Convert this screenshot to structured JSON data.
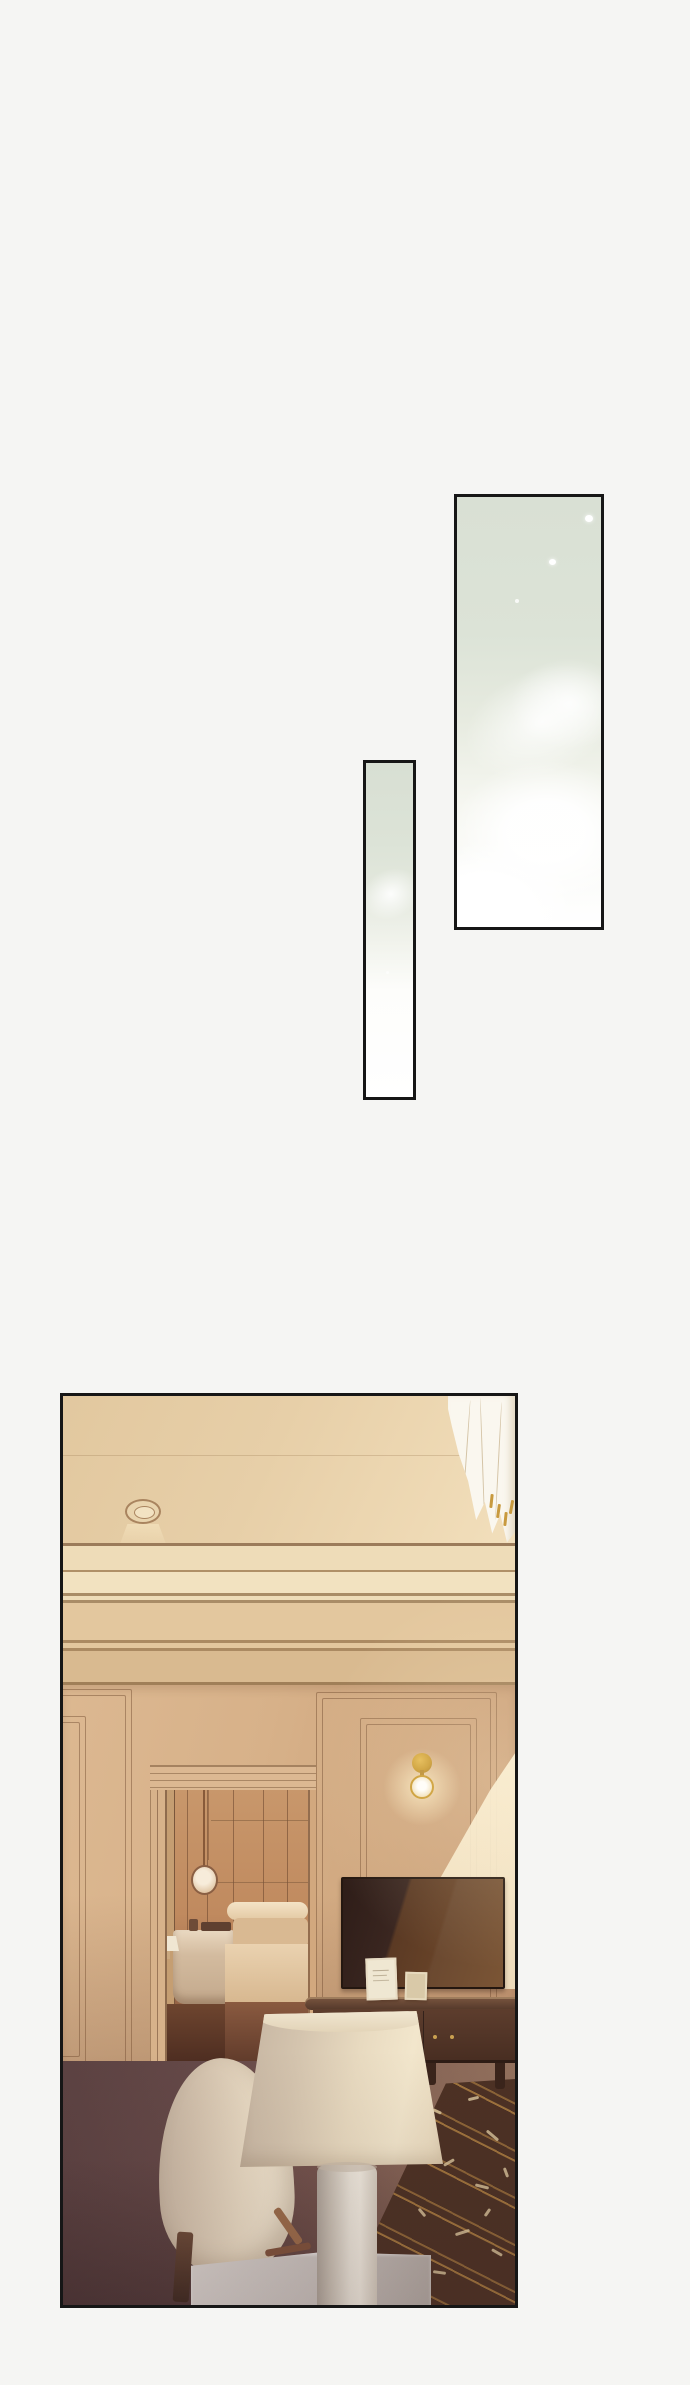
{
  "page": {
    "type": "webtoon-episode-strip",
    "background_color": "#f5f5f3",
    "visible_text": "none",
    "panel_border_color": "#161616"
  },
  "palette": {
    "sky_sage": "#dce3d7",
    "ceiling_tan": "#e6cfa8",
    "cornice_cream": "#f0e0bd",
    "wall_tan": "#d7b28a",
    "sun_patch": "#f7eed6",
    "sconce_gold": "#c9992e",
    "tv_screen_brown": "#4a2e1f",
    "console_wood": "#5f3f2e",
    "floor_dark_maroon": "#4a3336",
    "floor_mauve": "#8a685c",
    "rug_brown": "#4c3124",
    "rug_gold_stripe": "#b98a49",
    "rug_pattern_cream": "#d9c9a8",
    "lampshade_cream": "#e9dcc2",
    "lamp_body_white": "#e9e4dc",
    "armchair_cream": "#e3d3bd",
    "marble_table_gray": "#cfc8c4",
    "curtain_white": "#faf7ef",
    "doorway_warm": "#b5805c",
    "bedding_cream": "#ecd8b6"
  },
  "panels": [
    {
      "id": "panel-sky-tall",
      "description": "Tall narrow comic panel: pale sage-green sky fading to white with soft cloud shapes and tiny light specks",
      "x": 454,
      "y": 494,
      "width": 150,
      "height": 436
    },
    {
      "id": "panel-sky-sliver",
      "description": "Very narrow comic panel: pale sage-green fading diagonally to white",
      "x": 363,
      "y": 760,
      "width": 53,
      "height": 340
    },
    {
      "id": "panel-room",
      "description": "Large comic panel: warm sunlit living room with ceiling downlight, crown molding, paneled walls, doorway to a bedroom, brass wall sconce, TV on wood console, patterned rug, table lamp, cream armchair and white draped curtain",
      "x": 60,
      "y": 1393,
      "width": 458,
      "height": 915,
      "scene_items": [
        "draped-curtain",
        "ceiling-downlight",
        "crown-molding",
        "wall-panel-moldings",
        "doorway-to-bedroom",
        "hanging-round-mirror",
        "bedside-table",
        "bed",
        "bedroom-lamp",
        "wall-sconce",
        "sunlight-patch",
        "television",
        "picture-frames",
        "media-console",
        "patterned-rug",
        "table-lamp",
        "armchair",
        "marble-side-table",
        "dark-floor"
      ]
    }
  ]
}
